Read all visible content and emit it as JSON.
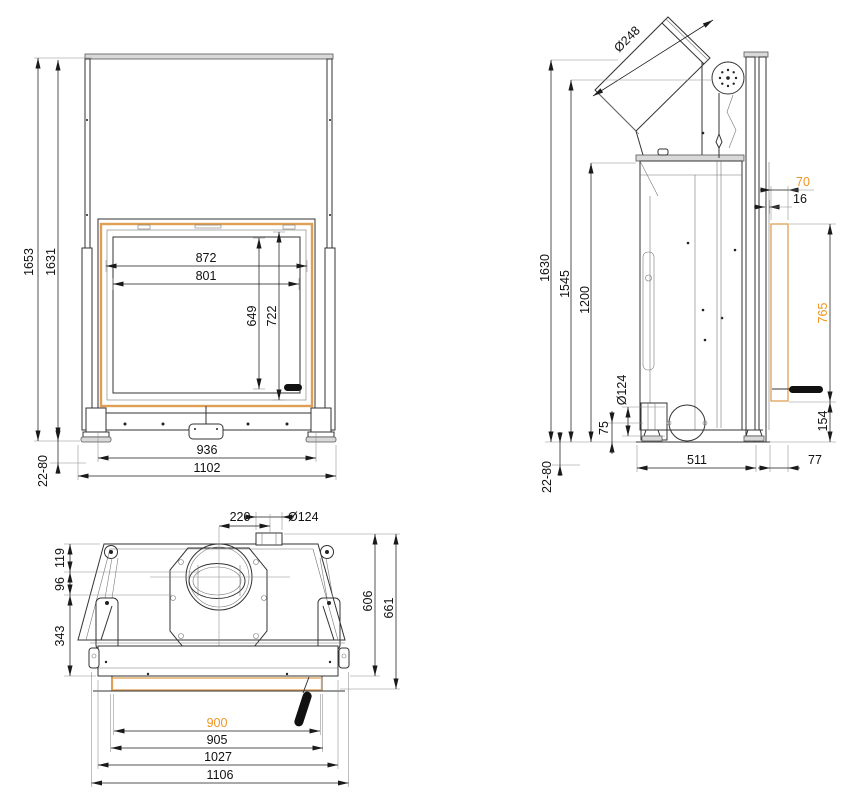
{
  "colors": {
    "line": "#2a2a2a",
    "dim_text": "#111111",
    "accent_text": "#ee9622",
    "accent_frame": "#dfa055"
  },
  "front": {
    "total_height": "1653",
    "frame_height": "1631",
    "foot_adjust": "22-80",
    "glass_width": "872",
    "opening_width": "801",
    "opening_height": "649",
    "glass_height": "722",
    "base_width": "936",
    "total_width": "1102"
  },
  "side": {
    "flue_diameter": "Ø248",
    "height_flue": "1630",
    "height_pulley": "1545",
    "height_body": "1200",
    "door_depth": "70",
    "rail_depth": "16",
    "door_height": "765",
    "bottom_height": "154",
    "air_inlet_diameter": "Ø124",
    "air_inlet_height": "75",
    "base_depth": "511",
    "front_offset": "77",
    "foot_adjust": "22-80"
  },
  "top": {
    "flue_offset": "220",
    "air_duct_diameter": "Ø124",
    "lug_depth": "119",
    "collar_offset": "96",
    "body_depth": "343",
    "frame_depth": "606",
    "total_depth": "661",
    "glass_width": "900",
    "opening_width": "905",
    "frame_width": "1027",
    "total_width": "1106"
  }
}
